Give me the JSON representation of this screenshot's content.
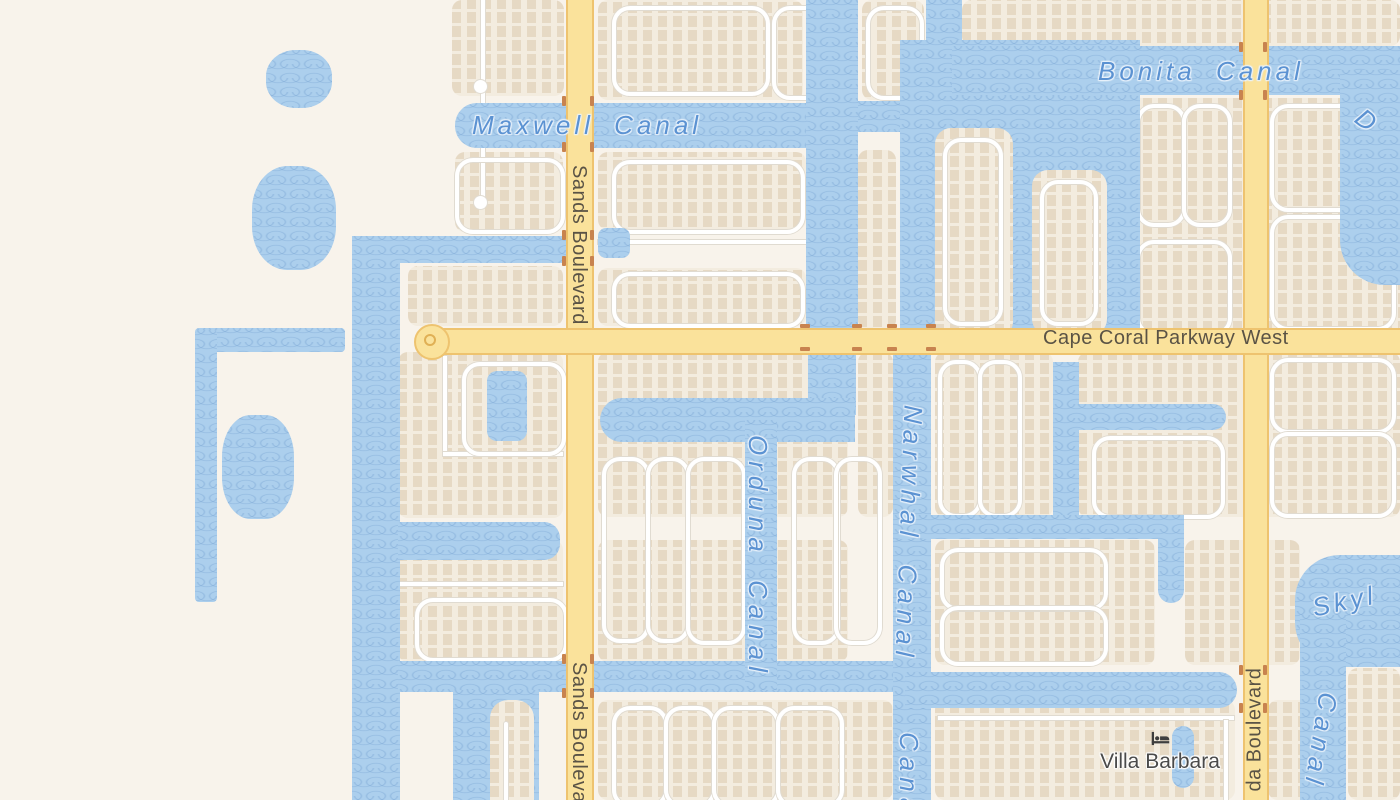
{
  "map": {
    "labels": {
      "canal_maxwell": "Maxwell Canal",
      "canal_bonita": "Bonita Canal",
      "canal_orduna": "Orduna Canal",
      "canal_narwhal": "Narwhal Canal",
      "canal_fragment_south": "Canal",
      "canal_fragment_sky": "Skyl",
      "canal_fragment_sky_canal": "Canal",
      "canal_fragment_d": "D",
      "road_sands": "Sands Boulevard",
      "road_sands_south": "Sands Boulevard",
      "road_parkway": "Cape Coral Parkway West",
      "road_agualinda_fragment": "da Boulevard"
    },
    "poi": {
      "villa_barbara": {
        "name": "Villa Barbara",
        "icon": "lodging-icon"
      }
    },
    "colors": {
      "water": "#accfed",
      "water_wave": "#8fb4dd",
      "land": "#f8f3eb",
      "block": "#f3ecdf",
      "building": "#e6d9c4",
      "road_fill": "#fae29b",
      "road_casing": "#eec36f",
      "street": "#ffffff",
      "street_casing": "#e0dbd1",
      "canal_label": "#5b92d2",
      "road_label": "#5a5345",
      "bridge_tick": "#c8834f",
      "poi_label": "#4a4a4a"
    }
  }
}
